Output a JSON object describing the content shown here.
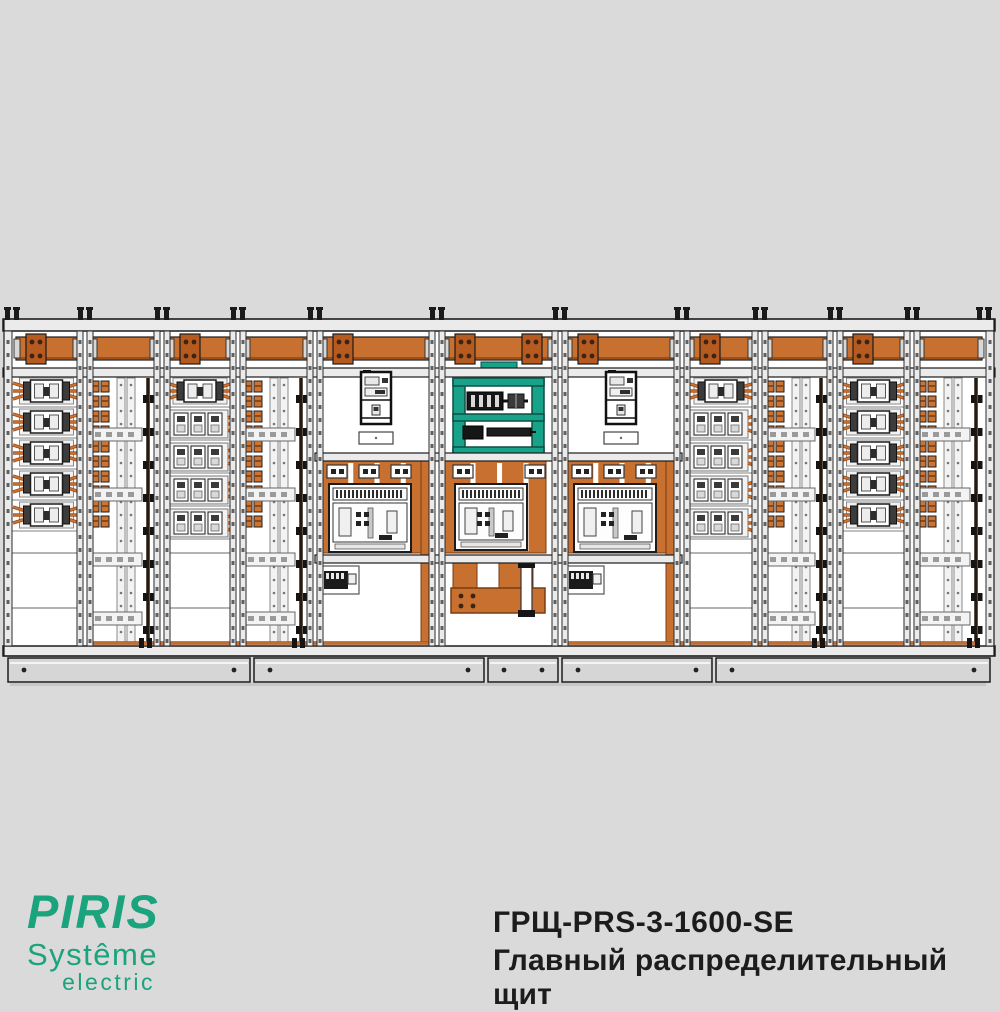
{
  "page": {
    "background": "#dadada"
  },
  "branding": {
    "name": "PIRIS",
    "line2": "Systême",
    "line3": "electric",
    "color": "#1aa37c"
  },
  "product": {
    "model": "ГРЩ-PRS-3-1600-SE",
    "title": "Главный распределительный щит",
    "text_color": "#1c1c1c"
  },
  "drawing": {
    "name": "main-distribution-switchboard-front-view",
    "colors": {
      "outline": "#1c1c1c",
      "frame": "#ebebeb",
      "frame_shade": "#cfcfcf",
      "interior": "#ffffff",
      "busbar": "#c8702f",
      "busbar_joint": "#b65a1f",
      "copper_dark": "#a3521d",
      "copper_light": "#cd7433",
      "teal": "#18a28a",
      "dark": "#1a1a1a",
      "plinth": "#d6d6d6",
      "bolt": "#3a2413"
    },
    "body": {
      "x0": 4,
      "x1": 994,
      "top": 319,
      "bus_top": 331,
      "bus_bottom": 368,
      "equip_top": 377,
      "equip_bottom": 646,
      "bottom": 656,
      "plinth_top": 658,
      "plinth_bottom": 682
    },
    "sections": [
      {
        "id": "feeder-1",
        "type": "feeder_small",
        "x0": 8,
        "x1": 85,
        "joint": "left"
      },
      {
        "id": "cable-1",
        "type": "cable",
        "x0": 85,
        "x1": 162,
        "joint": "none"
      },
      {
        "id": "feeder-2",
        "type": "feeder_large",
        "x0": 162,
        "x1": 238,
        "joint": "left"
      },
      {
        "id": "cable-2",
        "type": "cable",
        "x0": 238,
        "x1": 315,
        "joint": "none"
      },
      {
        "id": "incomer-1",
        "type": "incomer",
        "x0": 315,
        "x1": 437,
        "joint": "left"
      },
      {
        "id": "coupler",
        "type": "coupler",
        "x0": 437,
        "x1": 560,
        "joint": "both"
      },
      {
        "id": "incomer-2",
        "type": "incomer",
        "x0": 560,
        "x1": 682,
        "joint": "left"
      },
      {
        "id": "feeder-3",
        "type": "feeder_large",
        "x0": 682,
        "x1": 760,
        "joint": "left"
      },
      {
        "id": "cable-3",
        "type": "cable",
        "x0": 760,
        "x1": 835,
        "joint": "none"
      },
      {
        "id": "feeder-4",
        "type": "feeder_small",
        "x0": 835,
        "x1": 912,
        "joint": "left"
      },
      {
        "id": "cable-4",
        "type": "cable",
        "x0": 912,
        "x1": 990,
        "joint": "none"
      }
    ],
    "plinth_segments": [
      [
        8,
        250
      ],
      [
        254,
        484
      ],
      [
        488,
        558
      ],
      [
        562,
        712
      ],
      [
        716,
        990
      ]
    ],
    "bottom_cable_runs": [
      [
        90,
        434
      ],
      [
        568,
        976
      ]
    ],
    "cable_clamp_x": [
      148,
      301,
      821,
      976
    ]
  }
}
